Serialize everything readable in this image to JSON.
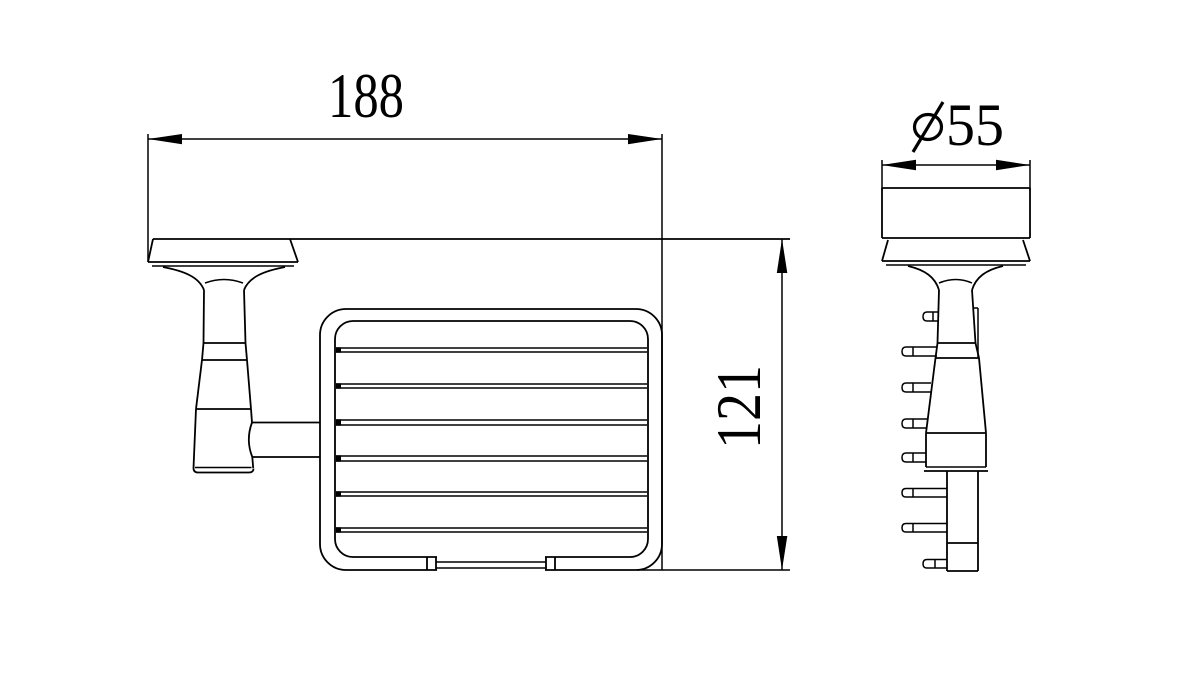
{
  "colors": {
    "background": "#ffffff",
    "line": "#000000"
  },
  "dimensions": {
    "width": {
      "value": "188"
    },
    "height": {
      "value": "121"
    },
    "diameter": {
      "value": "55",
      "symbol": "⌀"
    }
  }
}
